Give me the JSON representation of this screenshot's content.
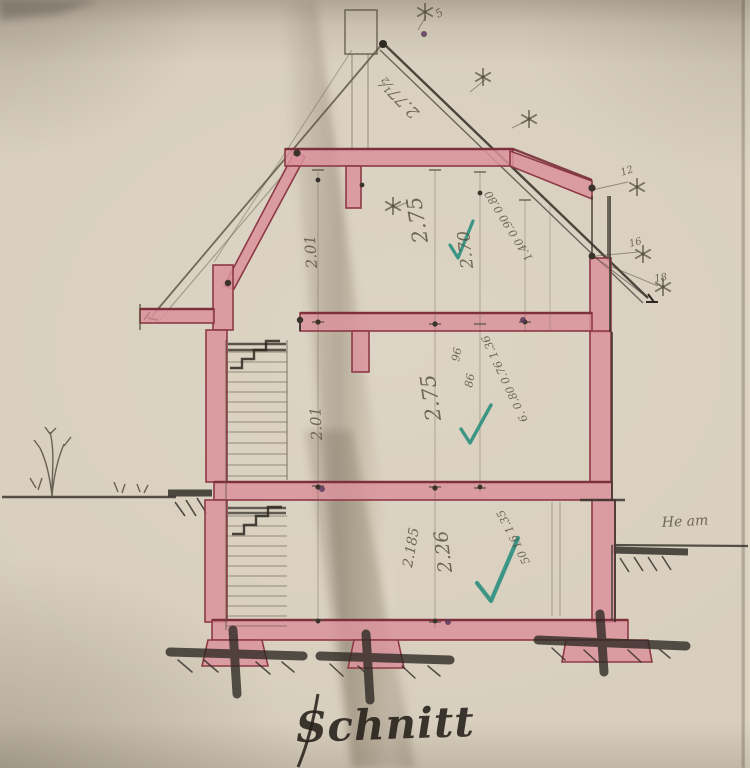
{
  "document": {
    "type": "hand-drawn architectural section drawing (photograph of old paper plan)",
    "language": "German"
  },
  "title": {
    "text": "Schnitt"
  },
  "palette": {
    "paper": "#d8cfbe",
    "ink": "#3c362e",
    "pencil": "#57503f",
    "wall_fill": "#d9939b",
    "wall_edge": "#8e3a46",
    "band_edge_dark": "#7a2e39",
    "check_green": "#2b8f7e",
    "hatch_dark": "#2b2721",
    "dot_purple": "#5a3b5c"
  },
  "annotations": [
    {
      "id": "roof-slope-dim",
      "text": "2.77½",
      "x": 420,
      "y": 112,
      "rotate": -134,
      "size": 16
    },
    {
      "id": "attic-left-height",
      "text": "2.01",
      "x": 317,
      "y": 268,
      "rotate": -94,
      "size": 15
    },
    {
      "id": "attic-main-height",
      "text": "2.75",
      "x": 428,
      "y": 242,
      "rotate": -99,
      "size": 21
    },
    {
      "id": "attic-clear-height",
      "text": "2.70",
      "x": 473,
      "y": 268,
      "rotate": -96,
      "size": 17
    },
    {
      "id": "attic-right-chain",
      "text": "1.40  0.90  0.80",
      "x": 533,
      "y": 258,
      "rotate": -122,
      "size": 11
    },
    {
      "id": "mid-left-height",
      "text": "2.01",
      "x": 322,
      "y": 440,
      "rotate": -93,
      "size": 15
    },
    {
      "id": "mid-main-height",
      "text": "2.75",
      "x": 441,
      "y": 420,
      "rotate": -98,
      "size": 21
    },
    {
      "id": "mid-small-dim-a",
      "text": "96",
      "x": 459,
      "y": 362,
      "rotate": -80,
      "size": 11
    },
    {
      "id": "mid-small-dim-b",
      "text": "86",
      "x": 472,
      "y": 388,
      "rotate": -80,
      "size": 11
    },
    {
      "id": "mid-right-chain",
      "text": "6.  0.80  0.76  1.36",
      "x": 528,
      "y": 420,
      "rotate": -115,
      "size": 11
    },
    {
      "id": "ground-left-dim",
      "text": "2.185",
      "x": 412,
      "y": 568,
      "rotate": -80,
      "size": 14
    },
    {
      "id": "ground-main-height",
      "text": "2.26",
      "x": 452,
      "y": 572,
      "rotate": -97,
      "size": 19
    },
    {
      "id": "ground-right-chain",
      "text": "50  16  1.35",
      "x": 530,
      "y": 562,
      "rotate": -117,
      "size": 11
    },
    {
      "id": "terrain-note",
      "text": "He am",
      "x": 662,
      "y": 527,
      "rotate": -3,
      "size": 14
    },
    {
      "id": "right-mark-a",
      "text": "12",
      "x": 622,
      "y": 176,
      "rotate": -20,
      "size": 10
    },
    {
      "id": "right-mark-b",
      "text": "16",
      "x": 630,
      "y": 247,
      "rotate": -15,
      "size": 10
    },
    {
      "id": "right-mark-c",
      "text": "18",
      "x": 655,
      "y": 282,
      "rotate": -10,
      "size": 10
    },
    {
      "id": "peak-mark",
      "text": "5",
      "x": 438,
      "y": 18,
      "rotate": -30,
      "size": 11
    }
  ],
  "stars": [
    {
      "x": 425,
      "y": 12
    },
    {
      "x": 483,
      "y": 77
    },
    {
      "x": 529,
      "y": 119
    },
    {
      "x": 393,
      "y": 206
    },
    {
      "x": 637,
      "y": 187
    },
    {
      "x": 643,
      "y": 254
    },
    {
      "x": 663,
      "y": 287
    }
  ],
  "checkmarks": [
    {
      "x1": 450,
      "y1": 245,
      "x2": 458,
      "y2": 258,
      "x3": 473,
      "y3": 221,
      "w": 3.2
    },
    {
      "x1": 461,
      "y1": 429,
      "x2": 470,
      "y2": 443,
      "x3": 491,
      "y3": 405,
      "w": 3.4
    },
    {
      "x1": 477,
      "y1": 583,
      "x2": 491,
      "y2": 601,
      "x3": 518,
      "y3": 538,
      "w": 4.2
    }
  ],
  "purple_dots": [
    {
      "x": 424,
      "y": 34
    },
    {
      "x": 322,
      "y": 489
    },
    {
      "x": 523,
      "y": 320
    },
    {
      "x": 448,
      "y": 622
    }
  ]
}
